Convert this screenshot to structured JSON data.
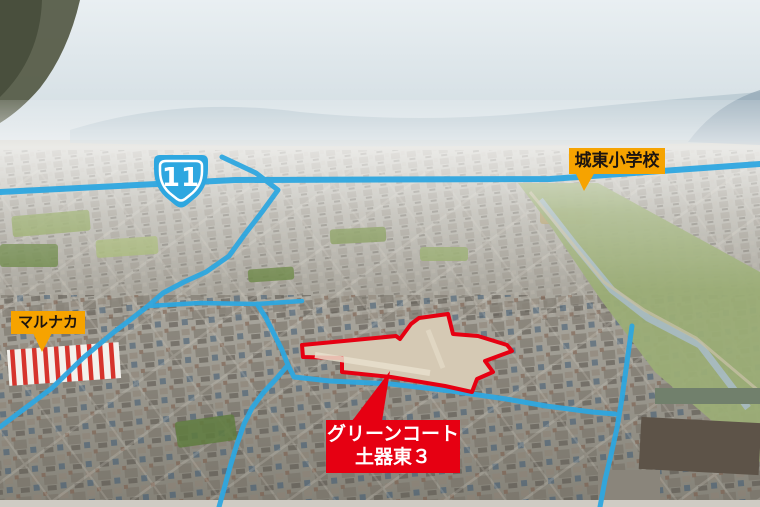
{
  "canvas": {
    "width": 760,
    "height": 507
  },
  "colors": {
    "road_line": "#2ea7e0",
    "badge_blue": "#2ea7e0",
    "site_outline": "#e60012",
    "site_fill": "#d5c9b4",
    "label_orange": "#f6a300",
    "label_red": "#e60012",
    "text_dark": "#1c1410",
    "text_light": "#ffffff"
  },
  "annotations": {
    "route_badge": {
      "number": "11"
    },
    "labels": {
      "school": {
        "text": "城東小学校"
      },
      "marunaka": {
        "text": "マルナカ"
      },
      "site": {
        "line1": "グリーンコート",
        "line2": "土器東３"
      }
    }
  }
}
